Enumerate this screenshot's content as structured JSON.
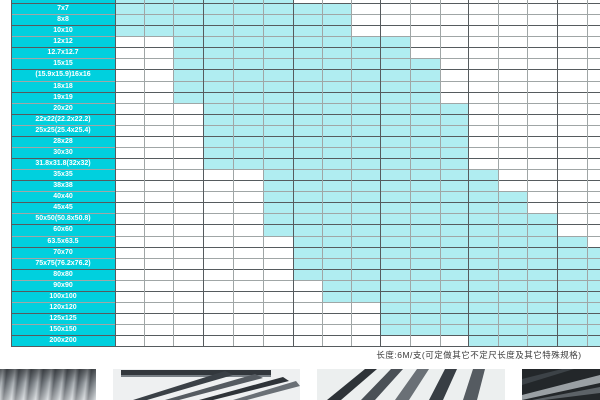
{
  "table": {
    "caption": "长度:6M/支(可定做其它不定尺长度及其它特殊规格)",
    "colors": {
      "label_column_bg": "#00d0de",
      "available_cell": "#b0edf1",
      "empty_cell": "#ffffff",
      "grid_line": "#a0a6a6",
      "grid_line_dark": "#565b5e",
      "label_text": "#ffffff",
      "caption_text": "#3a3a3a"
    },
    "rows": [
      {
        "label": "6x6",
        "available_from_col": 0,
        "available_to_col": 5
      },
      {
        "label": "7x7",
        "available_from_col": 0,
        "available_to_col": 7
      },
      {
        "label": "8x8",
        "available_from_col": 0,
        "available_to_col": 7
      },
      {
        "label": "10x10",
        "available_from_col": 0,
        "available_to_col": 7
      },
      {
        "label": "12x12",
        "available_from_col": 2,
        "available_to_col": 9
      },
      {
        "label": "12.7x12.7",
        "available_from_col": 2,
        "available_to_col": 9
      },
      {
        "label": "15x15",
        "available_from_col": 2,
        "available_to_col": 10
      },
      {
        "label": "(15.9x15.9)16x16",
        "available_from_col": 2,
        "available_to_col": 10
      },
      {
        "label": "18x18",
        "available_from_col": 2,
        "available_to_col": 10
      },
      {
        "label": "19x19",
        "available_from_col": 2,
        "available_to_col": 10
      },
      {
        "label": "20x20",
        "available_from_col": 3,
        "available_to_col": 11
      },
      {
        "label": "22x22(22.2x22.2)",
        "available_from_col": 3,
        "available_to_col": 11
      },
      {
        "label": "25x25(25.4x25.4)",
        "available_from_col": 3,
        "available_to_col": 11
      },
      {
        "label": "28x28",
        "available_from_col": 3,
        "available_to_col": 11
      },
      {
        "label": "30x30",
        "available_from_col": 3,
        "available_to_col": 11
      },
      {
        "label": "31.8x31.8(32x32)",
        "available_from_col": 3,
        "available_to_col": 11
      },
      {
        "label": "35x35",
        "available_from_col": 5,
        "available_to_col": 12
      },
      {
        "label": "38x38",
        "available_from_col": 5,
        "available_to_col": 12
      },
      {
        "label": "40x40",
        "available_from_col": 5,
        "available_to_col": 13
      },
      {
        "label": "45x45",
        "available_from_col": 5,
        "available_to_col": 13
      },
      {
        "label": "50x50(50.8x50.8)",
        "available_from_col": 5,
        "available_to_col": 14
      },
      {
        "label": "60x60",
        "available_from_col": 5,
        "available_to_col": 14
      },
      {
        "label": "63.5x63.5",
        "available_from_col": 6,
        "available_to_col": 15
      },
      {
        "label": "70x70",
        "available_from_col": 6,
        "available_to_col": 16
      },
      {
        "label": "75x75(76.2x76.2)",
        "available_from_col": 6,
        "available_to_col": 16
      },
      {
        "label": "80x80",
        "available_from_col": 6,
        "available_to_col": 16
      },
      {
        "label": "90x90",
        "available_from_col": 7,
        "available_to_col": 16
      },
      {
        "label": "100x100",
        "available_from_col": 7,
        "available_to_col": 16
      },
      {
        "label": "120x120",
        "available_from_col": 9,
        "available_to_col": 16
      },
      {
        "label": "125x125",
        "available_from_col": 9,
        "available_to_col": 16
      },
      {
        "label": "150x150",
        "available_from_col": 9,
        "available_to_col": 16
      },
      {
        "label": "200x200",
        "available_from_col": 12,
        "available_to_col": 16
      }
    ]
  },
  "photos": [
    {
      "name": "round-steel-bars-photo"
    },
    {
      "name": "fanned-steel-profiles-photo"
    },
    {
      "name": "fanned-square-tubes-photo"
    },
    {
      "name": "dark-steel-profiles-photo"
    }
  ]
}
